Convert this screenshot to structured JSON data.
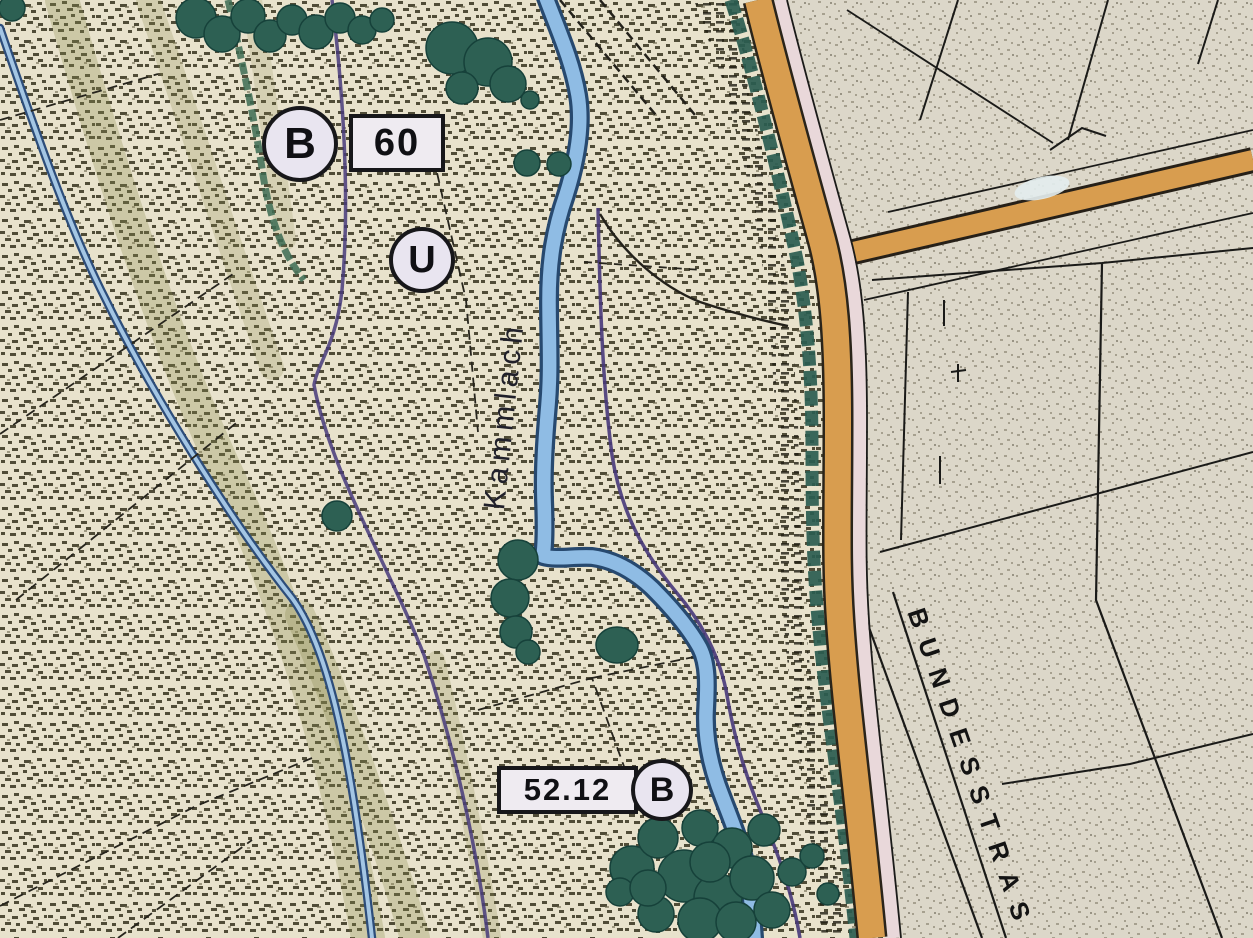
{
  "map": {
    "labels": {
      "badge_b_top": "B",
      "route_number": "60",
      "badge_u": "U",
      "measure_value": "52.12",
      "badge_b_bottom": "B",
      "stream_name": "Kammlach",
      "road_name": "BUNDESSTRAS"
    },
    "colors": {
      "stipple_background": "#e8e2cc",
      "stipple_dot": "#34311d",
      "pale_parcel_area": "#dcd7c9",
      "road_orange": "#d89d4f",
      "road_pink_strip": "#e9d8da",
      "stream_fill": "#8fbce4",
      "stream_edge": "#27496f",
      "tree_green": "#2d6053",
      "vegetation_teal": "#2a5c50",
      "olive_band": "#8c8c4e",
      "boundary_purple": "#47397a",
      "line_black": "#1b1b19"
    }
  }
}
